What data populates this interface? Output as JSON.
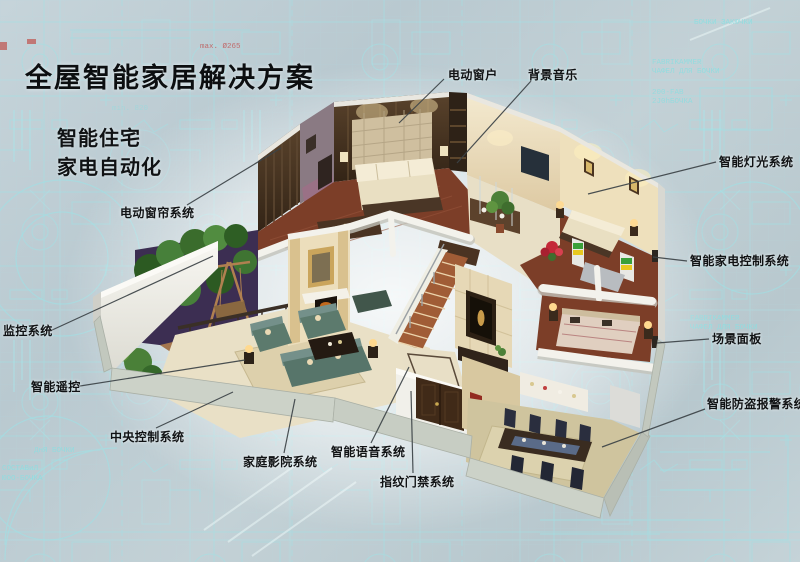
{
  "page": {
    "title": "全屋智能家居解决方案",
    "subtitle_line1": "智能住宅",
    "subtitle_line2": "家电自动化"
  },
  "callouts": [
    {
      "id": "electric-window",
      "label": "电动窗户"
    },
    {
      "id": "background-music",
      "label": "背景音乐"
    },
    {
      "id": "smart-lighting",
      "label": "智能灯光系统"
    },
    {
      "id": "appliance-control",
      "label": "智能家电控制系统"
    },
    {
      "id": "scene-panel",
      "label": "场景面板"
    },
    {
      "id": "burglar-alarm",
      "label": "智能防盗报警系统"
    },
    {
      "id": "curtain-system",
      "label": "电动窗帘系统"
    },
    {
      "id": "monitoring-system",
      "label": "监控系统"
    },
    {
      "id": "smart-remote",
      "label": "智能遥控"
    },
    {
      "id": "central-control",
      "label": "中央控制系统"
    },
    {
      "id": "home-theater",
      "label": "家庭影院系统"
    },
    {
      "id": "voice-system",
      "label": "智能语音系统"
    },
    {
      "id": "fingerprint-access",
      "label": "指纹门禁系统"
    }
  ],
  "background": {
    "annotations": [
      {
        "text": "БОЧКИ ЗАКЮЧКИ"
      },
      {
        "text": "FABRIKAMMER"
      },
      {
        "text": "ЧАФЕЛ ДЛЯ БОЧКИ"
      },
      {
        "text": "200-FAB"
      },
      {
        "text": "2J0hБОЧКА"
      },
      {
        "text": "A — A"
      },
      {
        "text": "min. 820"
      },
      {
        "text": "max. Ø265"
      },
      {
        "text": "ДнЯ БОЧКИ"
      },
      {
        "text": "СОСТАВиЛ"
      },
      {
        "text": "ЮОО-БОЧКА"
      }
    ]
  },
  "colors": {
    "background": "#bfced4",
    "blueprint_line": "#9fe2e6",
    "label_text": "#101214",
    "leader_line": "#3c4347",
    "glow": "#ffffff",
    "wall_beige": "#eadcba",
    "wood_floor": "#7c3e28",
    "cut_wall_white": "#f3f2ec",
    "sofa_teal": "#5c7a6d",
    "dark_wood": "#46321f"
  }
}
